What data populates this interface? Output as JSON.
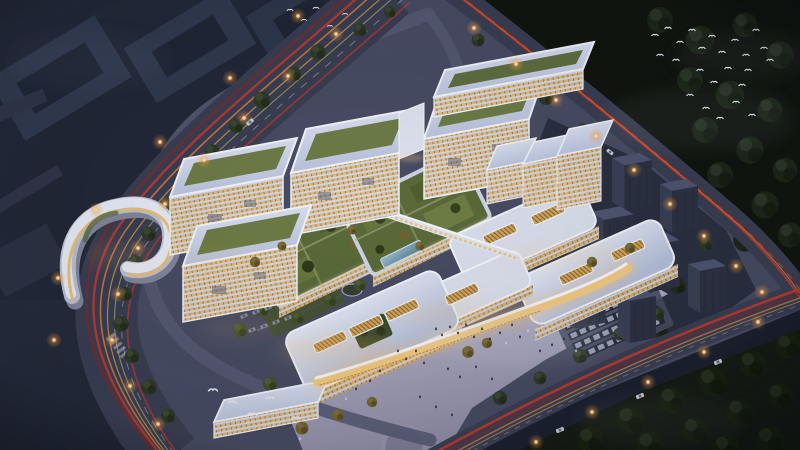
{
  "scene": {
    "palette": {
      "night_ground": "#242a3a",
      "campus_ground": "#4a4e66",
      "road": "#3a3e52",
      "road_minor": "#565a73",
      "plaza": "#b3b1c8",
      "forest": "#11150f",
      "forest_soft": "#161c14",
      "residential_zone": "#272d3d",
      "dark_tower_top": "#4e5570",
      "roof_white": "#d9deec",
      "green_roof": "#5a6a3a",
      "window_warm": "#e3b975",
      "facade_band": "#d4d9e8",
      "trail_red": "#c8392b",
      "trail_red_deep": "#8e2620",
      "trail_orange": "#e2823c",
      "trail_amber": "#e8ab4e",
      "trail_yellow": "#cfc566",
      "trail_white": "#e8ecf4",
      "lamp_glow": "#ffc97e",
      "canopy_glow": "#f1ca82",
      "glass_blue": "#7fa8ba",
      "parking_base": "#474c61"
    },
    "scatter": {
      "trees_road": {
        "symbol": "#sym-tree",
        "name": "roadside-tree",
        "color": "#2e3a26",
        "pts": [
          [
            318,
            52,
            1.2
          ],
          [
            294,
            74,
            1.1
          ],
          [
            262,
            100,
            1.3
          ],
          [
            236,
            126,
            1.1
          ],
          [
            212,
            152,
            1.2
          ],
          [
            190,
            178,
            1.1
          ],
          [
            167,
            206,
            1.3
          ],
          [
            149,
            234,
            1.1
          ],
          [
            135,
            263,
            1.2
          ],
          [
            125,
            294,
            1.1
          ],
          [
            121,
            324,
            1.2
          ],
          [
            132,
            356,
            1.1
          ],
          [
            149,
            387,
            1.2
          ],
          [
            168,
            416,
            1.1
          ],
          [
            360,
            30,
            1.0
          ],
          [
            390,
            12,
            0.9
          ],
          [
            478,
            40,
            1.0
          ],
          [
            512,
            68,
            1.0
          ],
          [
            546,
            98,
            1.1
          ],
          [
            582,
            130,
            1.0
          ],
          [
            706,
            244,
            1.0
          ],
          [
            500,
            398,
            1.1
          ],
          [
            540,
            378,
            1.0
          ],
          [
            580,
            356,
            1.1
          ],
          [
            620,
            334,
            1.0
          ],
          [
            658,
            314,
            1.0
          ],
          [
            694,
            292,
            1.0
          ]
        ]
      },
      "trees_campus": {
        "symbol": "#sym-tree",
        "name": "campus-tree",
        "color": "#43512c",
        "pts": [
          [
            330,
            250,
            1.1
          ],
          [
            310,
            270,
            1.0
          ],
          [
            288,
            292,
            1.2
          ],
          [
            262,
            310,
            1.0
          ],
          [
            240,
            330,
            1.1
          ],
          [
            298,
            318,
            0.9
          ],
          [
            330,
            300,
            1.0
          ],
          [
            360,
            285,
            0.9
          ],
          [
            185,
            215,
            1.0
          ],
          [
            205,
            236,
            1.1
          ],
          [
            228,
            256,
            0.9
          ],
          [
            188,
            276,
            1.0
          ],
          [
            212,
            300,
            1.1
          ],
          [
            252,
            238,
            0.9
          ],
          [
            300,
            366,
            1.0
          ],
          [
            270,
            384,
            1.1
          ],
          [
            238,
            286,
            0.9
          ],
          [
            476,
            186,
            0.9
          ],
          [
            508,
            160,
            0.9
          ],
          [
            448,
            206,
            0.9
          ]
        ]
      },
      "trees_autumn": {
        "symbol": "#sym-tree",
        "name": "autumn-tree",
        "color": "#72652f",
        "pts": [
          [
            468,
            352,
            0.9
          ],
          [
            487,
            343,
            0.8
          ],
          [
            302,
            428,
            1.0
          ],
          [
            338,
            415,
            0.9
          ],
          [
            372,
            402,
            0.8
          ],
          [
            255,
            262,
            0.8
          ],
          [
            282,
            246,
            0.7
          ],
          [
            352,
            230,
            0.7
          ],
          [
            420,
            246,
            0.7
          ],
          [
            592,
            262,
            0.8
          ],
          [
            630,
            248,
            0.8
          ]
        ]
      },
      "trees_forest_tr": {
        "symbol": "#sym-tree",
        "name": "forest-tree",
        "color": "#1c2618",
        "pts": [
          [
            660,
            20,
            2.0
          ],
          [
            700,
            40,
            2.2
          ],
          [
            745,
            25,
            1.9
          ],
          [
            780,
            55,
            2.1
          ],
          [
            690,
            80,
            2.0
          ],
          [
            730,
            95,
            2.2
          ],
          [
            770,
            110,
            1.9
          ],
          [
            705,
            130,
            2.0
          ],
          [
            750,
            150,
            2.1
          ],
          [
            785,
            170,
            1.9
          ],
          [
            720,
            175,
            2.0
          ],
          [
            765,
            205,
            2.1
          ],
          [
            790,
            235,
            1.9
          ],
          [
            745,
            240,
            1.8
          ]
        ]
      },
      "trees_forest_br": {
        "symbol": "#sym-tree",
        "name": "forest-tree",
        "color": "#18220f",
        "pts": [
          [
            590,
            440,
            2.0
          ],
          [
            630,
            420,
            2.1
          ],
          [
            672,
            400,
            2.0
          ],
          [
            712,
            382,
            2.2
          ],
          [
            752,
            364,
            2.0
          ],
          [
            788,
            346,
            1.9
          ],
          [
            650,
            445,
            2.1
          ],
          [
            695,
            430,
            2.0
          ],
          [
            740,
            412,
            2.1
          ],
          [
            780,
            396,
            2.0
          ],
          [
            770,
            440,
            2.2
          ],
          [
            726,
            448,
            2.0
          ]
        ]
      },
      "trees_res": {
        "symbol": "#sym-tree",
        "name": "residential-tree",
        "color": "#212c1b",
        "pts": [
          [
            565,
            200,
            1.3
          ],
          [
            600,
            230,
            1.2
          ],
          [
            640,
            256,
            1.3
          ],
          [
            678,
            286,
            1.2
          ],
          [
            560,
            250,
            1.2
          ],
          [
            590,
            286,
            1.3
          ],
          [
            620,
            312,
            1.2
          ],
          [
            660,
            330,
            1.3
          ],
          [
            545,
            312,
            1.2
          ],
          [
            575,
            332,
            1.1
          ]
        ]
      },
      "lamps": {
        "symbol": "#sym-lamp",
        "name": "street-lamp",
        "pts": [
          [
            336,
            34
          ],
          [
            288,
            76
          ],
          [
            244,
            118
          ],
          [
            204,
            160
          ],
          [
            165,
            204
          ],
          [
            138,
            248
          ],
          [
            118,
            294
          ],
          [
            112,
            340
          ],
          [
            130,
            386
          ],
          [
            158,
            424
          ],
          [
            298,
            16
          ],
          [
            230,
            78
          ],
          [
            160,
            142
          ],
          [
            96,
            210
          ],
          [
            58,
            278
          ],
          [
            54,
            340
          ],
          [
            474,
            28
          ],
          [
            516,
            64
          ],
          [
            556,
            100
          ],
          [
            596,
            136
          ],
          [
            634,
            170
          ],
          [
            670,
            204
          ],
          [
            704,
            236
          ],
          [
            736,
            266
          ],
          [
            762,
            292
          ],
          [
            758,
            322
          ],
          [
            704,
            352
          ],
          [
            648,
            382
          ],
          [
            592,
            412
          ],
          [
            536,
            442
          ]
        ]
      },
      "birds_tr": {
        "symbol": "#sym-bird",
        "name": "bird",
        "pts": [
          [
            655,
            35
          ],
          [
            668,
            28
          ],
          [
            680,
            42
          ],
          [
            692,
            30
          ],
          [
            702,
            48
          ],
          [
            712,
            36
          ],
          [
            722,
            52
          ],
          [
            735,
            40
          ],
          [
            746,
            55
          ],
          [
            756,
            30
          ],
          [
            764,
            48
          ],
          [
            700,
            70
          ],
          [
            714,
            82
          ],
          [
            728,
            68
          ],
          [
            742,
            85
          ],
          [
            690,
            95
          ],
          [
            706,
            108
          ],
          [
            720,
            118
          ],
          [
            736,
            102
          ],
          [
            752,
            115
          ],
          [
            676,
            60
          ],
          [
            748,
            70
          ],
          [
            660,
            55
          ],
          [
            770,
            60
          ]
        ]
      },
      "birds_bl": {
        "symbol": "#sym-bird",
        "name": "bird",
        "pts": [
          [
            213,
            390,
            1.4
          ],
          [
            232,
            402,
            1.3
          ],
          [
            252,
            414,
            1.4
          ],
          [
            270,
            398,
            1.2
          ],
          [
            296,
            418,
            1.3
          ]
        ]
      },
      "birds_tl": {
        "symbol": "#sym-bird",
        "name": "bird",
        "pts": [
          [
            290,
            10,
            0.9
          ],
          [
            304,
            20,
            0.8
          ],
          [
            316,
            8,
            0.9
          ],
          [
            330,
            26,
            0.8
          ],
          [
            345,
            14,
            0.8
          ]
        ]
      },
      "people_dark": {
        "symbol": "#sym-person",
        "name": "pedestrian",
        "color": "#262a38",
        "pts": [
          [
            436,
            330
          ],
          [
            442,
            336
          ],
          [
            450,
            328
          ],
          [
            458,
            334
          ],
          [
            466,
            326
          ],
          [
            474,
            338
          ],
          [
            482,
            330
          ],
          [
            490,
            340
          ],
          [
            500,
            334
          ],
          [
            512,
            326
          ],
          [
            520,
            338
          ],
          [
            398,
            352
          ],
          [
            406,
            360
          ],
          [
            416,
            352
          ],
          [
            424,
            364
          ],
          [
            380,
            372
          ],
          [
            370,
            382
          ],
          [
            356,
            390
          ],
          [
            448,
            370
          ],
          [
            460,
            378
          ],
          [
            476,
            368
          ],
          [
            492,
            380
          ],
          [
            540,
            352
          ],
          [
            552,
            346
          ],
          [
            564,
            340
          ],
          [
            420,
            398
          ],
          [
            436,
            408
          ],
          [
            452,
            416
          ]
        ]
      },
      "people_lit": {
        "symbol": "#sym-person",
        "name": "pedestrian",
        "color": "#cdd2e0",
        "pts": [
          [
            506,
            344
          ],
          [
            528,
            332
          ],
          [
            388,
            362
          ],
          [
            346,
            400
          ],
          [
            576,
            352
          ],
          [
            300,
            440
          ]
        ]
      },
      "cars_lot_small": {
        "symbol": "#sym-car",
        "name": "parked-car",
        "color": "#8a90a6",
        "pts": [
          [
            244,
            316,
            0.8,
            -24
          ],
          [
            256,
            312,
            0.8,
            -24
          ],
          [
            268,
            308,
            0.8,
            -24
          ],
          [
            280,
            304,
            0.8,
            -24
          ],
          [
            252,
            330,
            0.8,
            -24
          ],
          [
            264,
            326,
            0.8,
            -24
          ],
          [
            276,
            322,
            0.8,
            -24
          ],
          [
            288,
            318,
            0.8,
            -24
          ]
        ]
      },
      "cars_moving": {
        "symbol": "#sym-car",
        "name": "car",
        "color": "#c9cede",
        "pts": [
          [
            250,
            122,
            0.9,
            -42
          ],
          [
            162,
            262,
            0.9,
            -70
          ],
          [
            560,
            430,
            0.9,
            -22
          ],
          [
            640,
            396,
            0.9,
            -22
          ],
          [
            718,
            362,
            0.9,
            -22
          ],
          [
            610,
            152,
            0.8,
            38
          ]
        ]
      },
      "res_towers": {
        "symbol": "#sym-darktower",
        "name": "residential-tower",
        "pts": [
          [
            566,
            140,
            1.0
          ],
          [
            612,
            158,
            1.05
          ],
          [
            660,
            184,
            1.0
          ],
          [
            590,
            212,
            1.15
          ],
          [
            638,
            238,
            1.1
          ],
          [
            688,
            264,
            1.0
          ],
          [
            560,
            270,
            1.2
          ],
          [
            618,
            294,
            1.0
          ]
        ]
      }
    }
  }
}
